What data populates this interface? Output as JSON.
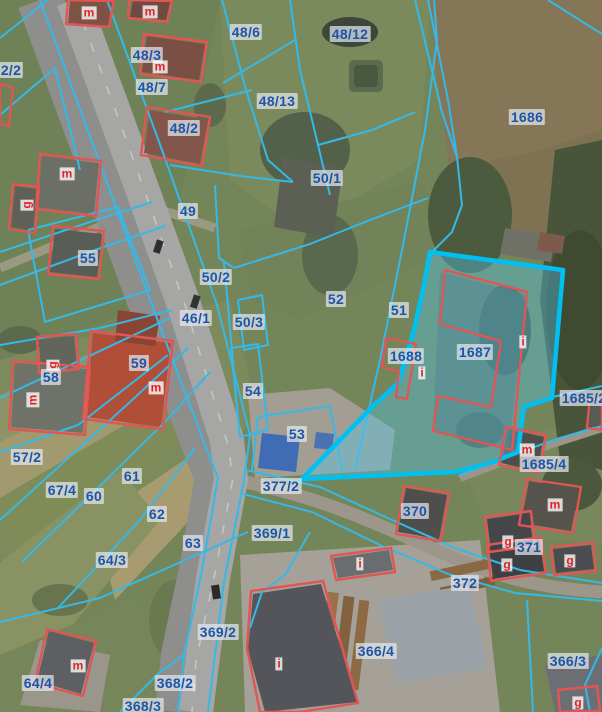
{
  "map": {
    "description": "Cadastral parcel map overlaid on aerial orthophoto",
    "highlighted_parcel": "1687",
    "colors": {
      "parcel_line": "#35b9e8",
      "parcel_label_text": "#1d55a8",
      "parcel_label_bg": "rgba(228,231,235,0.72)",
      "building_outline": "#e25555",
      "building_label_text": "#e02222",
      "building_label_bg": "rgba(255,255,255,0.78)",
      "highlight_stroke": "#00c0f2",
      "highlight_fill": "rgba(80,200,240,0.38)"
    }
  },
  "parcel_labels": [
    {
      "text": "2/2",
      "x": 11,
      "y": 70
    },
    {
      "text": "48/3",
      "x": 147,
      "y": 55
    },
    {
      "text": "48/6",
      "x": 246,
      "y": 32
    },
    {
      "text": "48/12",
      "x": 350,
      "y": 34
    },
    {
      "text": "48/7",
      "x": 152,
      "y": 87
    },
    {
      "text": "48/13",
      "x": 277,
      "y": 101
    },
    {
      "text": "48/2",
      "x": 184,
      "y": 128
    },
    {
      "text": "1686",
      "x": 527,
      "y": 117
    },
    {
      "text": "50/1",
      "x": 327,
      "y": 178
    },
    {
      "text": "49",
      "x": 188,
      "y": 211
    },
    {
      "text": "55",
      "x": 88,
      "y": 258
    },
    {
      "text": "50/2",
      "x": 216,
      "y": 277
    },
    {
      "text": "52",
      "x": 336,
      "y": 299
    },
    {
      "text": "51",
      "x": 399,
      "y": 310
    },
    {
      "text": "46/1",
      "x": 196,
      "y": 318
    },
    {
      "text": "50/3",
      "x": 249,
      "y": 322
    },
    {
      "text": "1687",
      "x": 475,
      "y": 352
    },
    {
      "text": "1688",
      "x": 406,
      "y": 356
    },
    {
      "text": "59",
      "x": 139,
      "y": 363
    },
    {
      "text": "58",
      "x": 51,
      "y": 377
    },
    {
      "text": "54",
      "x": 253,
      "y": 391
    },
    {
      "text": "1685/2",
      "x": 584,
      "y": 398
    },
    {
      "text": "53",
      "x": 297,
      "y": 434
    },
    {
      "text": "57/2",
      "x": 27,
      "y": 457
    },
    {
      "text": "1685/4",
      "x": 544,
      "y": 464
    },
    {
      "text": "61",
      "x": 132,
      "y": 476
    },
    {
      "text": "377/2",
      "x": 281,
      "y": 486
    },
    {
      "text": "67/4",
      "x": 62,
      "y": 490
    },
    {
      "text": "60",
      "x": 94,
      "y": 496
    },
    {
      "text": "370",
      "x": 415,
      "y": 511
    },
    {
      "text": "62",
      "x": 157,
      "y": 514
    },
    {
      "text": "369/1",
      "x": 272,
      "y": 533
    },
    {
      "text": "63",
      "x": 193,
      "y": 543
    },
    {
      "text": "371",
      "x": 529,
      "y": 547
    },
    {
      "text": "64/3",
      "x": 112,
      "y": 560
    },
    {
      "text": "372",
      "x": 465,
      "y": 583
    },
    {
      "text": "369/2",
      "x": 218,
      "y": 632
    },
    {
      "text": "366/4",
      "x": 376,
      "y": 651
    },
    {
      "text": "366/3",
      "x": 568,
      "y": 661
    },
    {
      "text": "64/4",
      "x": 38,
      "y": 683
    },
    {
      "text": "368/2",
      "x": 175,
      "y": 683
    },
    {
      "text": "368/3",
      "x": 143,
      "y": 706
    }
  ],
  "building_labels": [
    {
      "text": "m",
      "x": 89,
      "y": 13
    },
    {
      "text": "m",
      "x": 150,
      "y": 12
    },
    {
      "text": "m",
      "x": 160,
      "y": 67
    },
    {
      "text": "m",
      "x": 67,
      "y": 174
    },
    {
      "text": "g",
      "x": 27,
      "y": 205,
      "rotated": true
    },
    {
      "text": "g",
      "x": 53,
      "y": 365,
      "rotated": true
    },
    {
      "text": "m",
      "x": 33,
      "y": 400,
      "rotated": true
    },
    {
      "text": "m",
      "x": 156,
      "y": 388
    },
    {
      "text": "i",
      "x": 422,
      "y": 373
    },
    {
      "text": "i",
      "x": 523,
      "y": 342
    },
    {
      "text": "m",
      "x": 527,
      "y": 450
    },
    {
      "text": "m",
      "x": 555,
      "y": 505
    },
    {
      "text": "g",
      "x": 508,
      "y": 542
    },
    {
      "text": "g",
      "x": 507,
      "y": 565
    },
    {
      "text": "g",
      "x": 570,
      "y": 561
    },
    {
      "text": "i",
      "x": 360,
      "y": 564
    },
    {
      "text": "i",
      "x": 279,
      "y": 664
    },
    {
      "text": "m",
      "x": 78,
      "y": 666
    },
    {
      "text": "g",
      "x": 578,
      "y": 703
    }
  ]
}
